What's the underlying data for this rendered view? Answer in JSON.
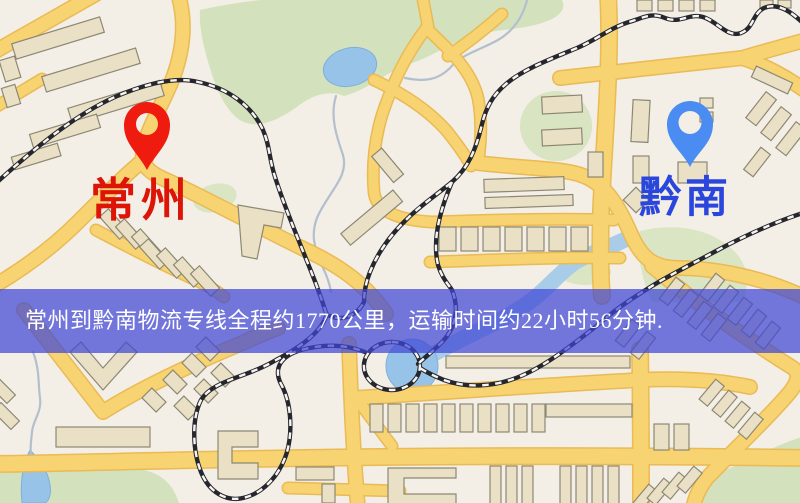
{
  "banner": {
    "text": "常州到黔南物流专线全程约1770公里，运输时间约22小时56分钟.",
    "background_color": "#4046d6",
    "text_color": "#ffffff"
  },
  "markers": {
    "origin": {
      "label": "常州",
      "pin_icon": "red-map-pin",
      "pin_color": "#ee1b0e",
      "label_color": "#dd1508"
    },
    "destination": {
      "label": "黔南",
      "pin_icon": "blue-map-pin",
      "pin_color": "#4b8cf2",
      "label_color": "#2a46dc"
    }
  },
  "route_info": {
    "from": "常州",
    "to": "黔南",
    "service": "物流专线",
    "distance": "约1770公里",
    "duration": "约22小时56分钟"
  },
  "map_colors": {
    "background": "#f3efe6",
    "road": "#f7d372",
    "road_edge": "#eaba55",
    "park": "#d3e2bc",
    "water": "#97c3e8",
    "railway": "#26262e",
    "building": "#eae0c5"
  }
}
